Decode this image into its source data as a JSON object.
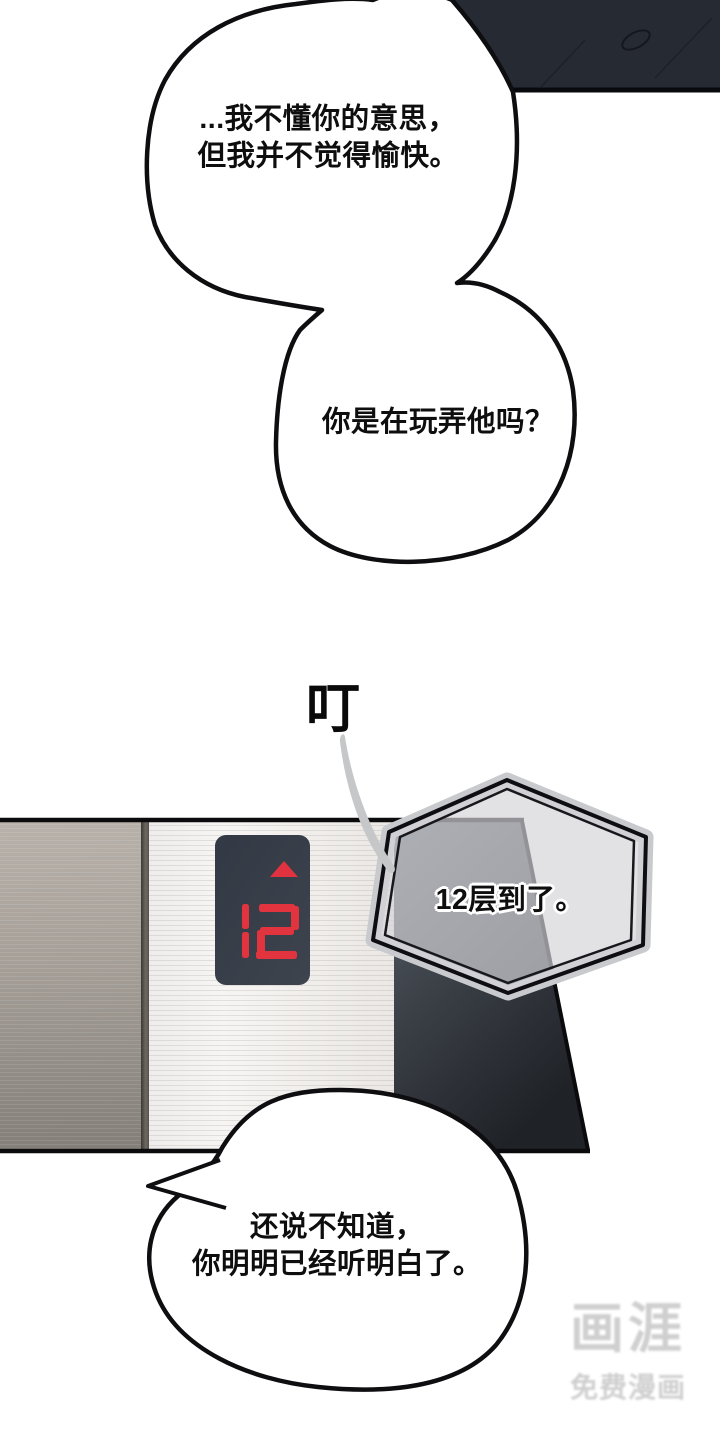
{
  "comic": {
    "bubbles": {
      "bubble1": {
        "line1": "...我不懂你的意思，",
        "line2": "但我并不觉得愉快。"
      },
      "bubble2": {
        "line1": "你是在玩弄他吗？"
      },
      "arrival": {
        "line1": "12层到了。"
      },
      "bubble3": {
        "line1": "还说不知道，",
        "line2": "你明明已经听明白了。"
      }
    },
    "sfx": {
      "ding": "叮"
    },
    "elevator_display": {
      "floor": "12",
      "direction": "up"
    },
    "watermark": {
      "logo": "画涯",
      "tagline": "免费漫画"
    },
    "colors": {
      "page_bg": "#ffffff",
      "outline_black": "#0e0e11",
      "display_panel": "#373d47",
      "display_digits": "#e2343f",
      "door_dark_top": "#59606a",
      "door_dark_bottom": "#202329",
      "metal_left": "#a49e97",
      "metal_bright": "#f4f2f0",
      "hexagon_fill": "#d6d6d9",
      "dark_clothing_panel": "#262a33",
      "swoosh_gray": "#c6c7c9",
      "watermark_gray": "#cfcfcf"
    }
  }
}
